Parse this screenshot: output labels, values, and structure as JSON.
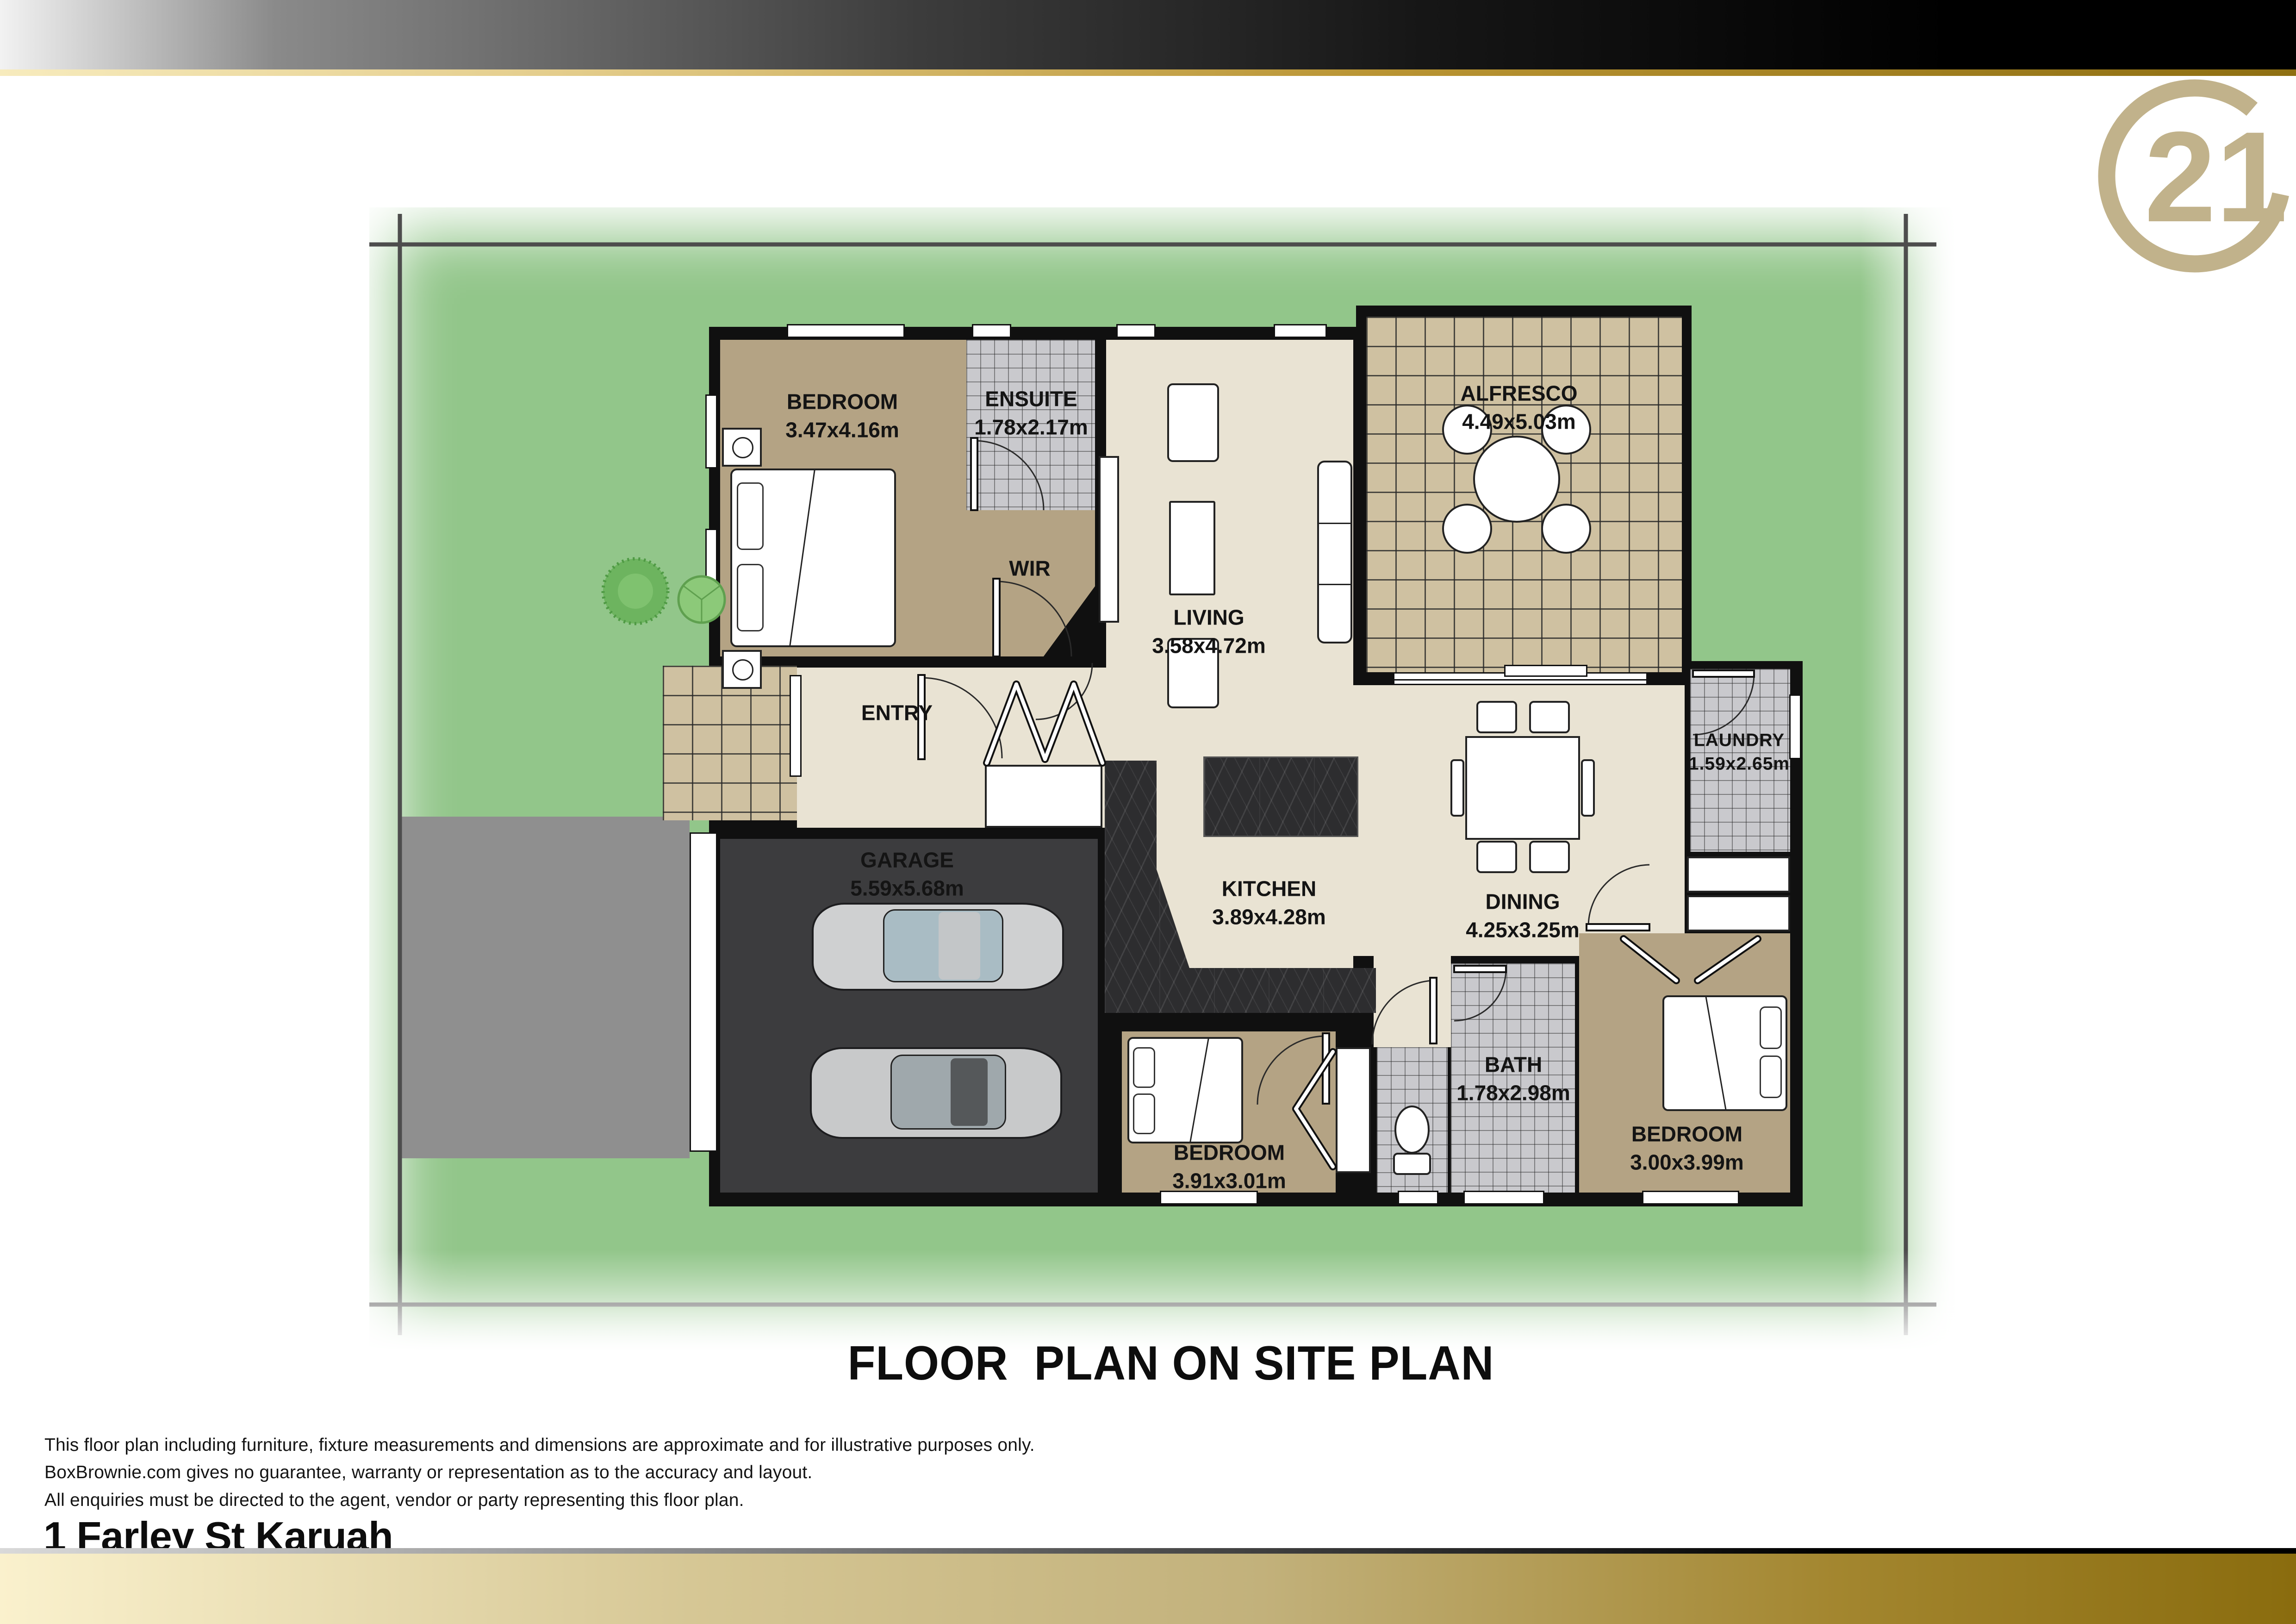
{
  "brand": {
    "logo_number": "21",
    "logo_color": "#c1b28b",
    "gold_dark": "#8a6c0e",
    "gold_light": "#faf1cd"
  },
  "title": "FLOOR  PLAN ON SITE PLAN",
  "rooms": {
    "bedroom1": {
      "name": "BEDROOM",
      "dims": "3.47x4.16m"
    },
    "ensuite": {
      "name": "ENSUITE",
      "dims": "1.78x2.17m"
    },
    "wir": {
      "name": "WIR"
    },
    "living": {
      "name": "LIVING",
      "dims": "3.58x4.72m"
    },
    "alfresco": {
      "name": "ALFRESCO",
      "dims": "4.49x5.03m"
    },
    "entry": {
      "name": "ENTRY"
    },
    "garage": {
      "name": "GARAGE",
      "dims": "5.59x5.68m"
    },
    "kitchen": {
      "name": "KITCHEN",
      "dims": "3.89x4.28m"
    },
    "dining": {
      "name": "DINING",
      "dims": "4.25x3.25m"
    },
    "laundry": {
      "name": "LAUNDRY",
      "dims": "1.59x2.65m"
    },
    "bedroom2": {
      "name": "BEDROOM",
      "dims": "3.91x3.01m"
    },
    "bath": {
      "name": "BATH",
      "dims": "1.78x2.98m"
    },
    "bedroom3": {
      "name": "BEDROOM",
      "dims": "3.00x3.99m"
    }
  },
  "footer": {
    "disclaimer1": "This floor plan including furniture, fixture measurements and dimensions are approximate and for illustrative purposes only.",
    "disclaimer2": "BoxBrownie.com gives no guarantee, warranty or representation as to the accuracy and layout.",
    "disclaimer3": "All enquiries must be directed to the agent, vendor or party representing this floor plan.",
    "address": "1 Farley St Karuah"
  },
  "colors": {
    "lawn": "#92c68a",
    "boundary": "#4d4d4d",
    "wall": "#101010",
    "tan_floor": "#b4a384",
    "cream_floor": "#e9e3d3",
    "gray_tile": "#c9c9cd",
    "tan_tile": "#cfc1a1",
    "garage_floor": "#3c3c3e",
    "marble_bench": "#2d2d2f",
    "driveway": "#8f8f8f"
  }
}
